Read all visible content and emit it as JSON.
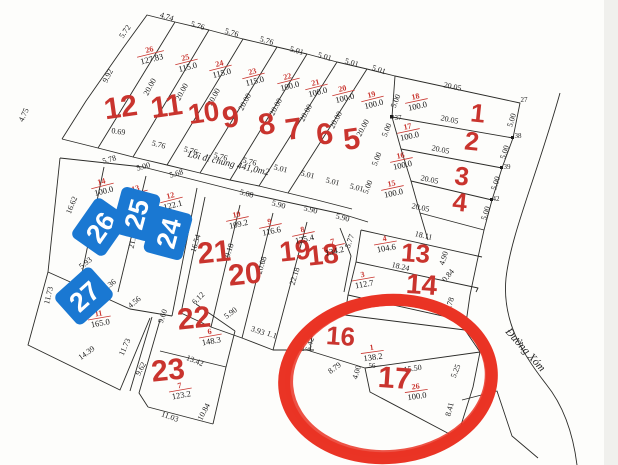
{
  "map": {
    "colors": {
      "background": "#fdfdfb",
      "line": "#2b2b28",
      "plot_number_red": "#c9342e",
      "stamp_blue": "#1a78d2",
      "stamp_text": "#ffffff",
      "highlight_circle": "#ea3425"
    },
    "road_labels": [
      {
        "text": "Lối đi chung 441,0m2",
        "x": 228,
        "y": 166,
        "r": 13,
        "size": 9.5
      },
      {
        "text": "Đường Xóm",
        "x": 523,
        "y": 352,
        "r": 48,
        "size": 11
      }
    ],
    "plot_numbers": [
      {
        "t": "1",
        "x": 477,
        "y": 122,
        "r": 6,
        "s": 26
      },
      {
        "t": "2",
        "x": 471,
        "y": 150,
        "r": 6,
        "s": 26
      },
      {
        "t": "3",
        "x": 461,
        "y": 185,
        "r": 6,
        "s": 26
      },
      {
        "t": "4",
        "x": 459,
        "y": 211,
        "r": 6,
        "s": 26
      },
      {
        "t": "5",
        "x": 353,
        "y": 149,
        "r": -8,
        "s": 30
      },
      {
        "t": "6",
        "x": 326,
        "y": 144,
        "r": -8,
        "s": 30
      },
      {
        "t": "7",
        "x": 295,
        "y": 139,
        "r": -8,
        "s": 30
      },
      {
        "t": "8",
        "x": 268,
        "y": 134,
        "r": -8,
        "s": 30
      },
      {
        "t": "9",
        "x": 232,
        "y": 127,
        "r": -8,
        "s": 30
      },
      {
        "t": "10",
        "x": 205,
        "y": 122,
        "r": -8,
        "s": 28
      },
      {
        "t": "11",
        "x": 168,
        "y": 116,
        "r": -8,
        "s": 30
      },
      {
        "t": "12",
        "x": 122,
        "y": 117,
        "r": -8,
        "s": 30
      },
      {
        "t": "13",
        "x": 415,
        "y": 262,
        "r": 4,
        "s": 26
      },
      {
        "t": "14",
        "x": 421,
        "y": 294,
        "r": 4,
        "s": 28
      },
      {
        "t": "16",
        "x": 340,
        "y": 345,
        "r": 4,
        "s": 26
      },
      {
        "t": "17",
        "x": 394,
        "y": 388,
        "r": 4,
        "s": 30
      },
      {
        "t": "18",
        "x": 324,
        "y": 264,
        "r": -6,
        "s": 28
      },
      {
        "t": "19",
        "x": 296,
        "y": 260,
        "r": -6,
        "s": 28
      },
      {
        "t": "20",
        "x": 246,
        "y": 284,
        "r": -6,
        "s": 30
      },
      {
        "t": "21",
        "x": 215,
        "y": 262,
        "r": -6,
        "s": 30
      },
      {
        "t": "22",
        "x": 195,
        "y": 328,
        "r": -6,
        "s": 30
      },
      {
        "t": "23",
        "x": 169,
        "y": 380,
        "r": -6,
        "s": 30
      }
    ],
    "parcel_labels": [
      {
        "id": "26",
        "area": "127.83",
        "x": 150,
        "y": 52,
        "r": -14
      },
      {
        "id": "25",
        "area": "115.0",
        "x": 186,
        "y": 60,
        "r": -14
      },
      {
        "id": "24",
        "area": "115.0",
        "x": 220,
        "y": 66,
        "r": -14
      },
      {
        "id": "23",
        "area": "115.0",
        "x": 253,
        "y": 74,
        "r": -14
      },
      {
        "id": "22",
        "area": "100.0",
        "x": 288,
        "y": 79,
        "r": -14
      },
      {
        "id": "21",
        "area": "100.0",
        "x": 316,
        "y": 85,
        "r": -14
      },
      {
        "id": "20",
        "area": "100.0",
        "x": 343,
        "y": 91,
        "r": -14
      },
      {
        "id": "19",
        "area": "100.0",
        "x": 372,
        "y": 97,
        "r": -14
      },
      {
        "id": "18",
        "area": "100.0",
        "x": 416,
        "y": 99,
        "r": -12
      },
      {
        "id": "17",
        "area": "100.0",
        "x": 408,
        "y": 129,
        "r": -12
      },
      {
        "id": "16",
        "area": "100.0",
        "x": 401,
        "y": 158,
        "r": -12
      },
      {
        "id": "15",
        "area": "100.0",
        "x": 392,
        "y": 186,
        "r": -12
      },
      {
        "id": "14",
        "area": "100.0",
        "x": 102,
        "y": 184,
        "r": -14
      },
      {
        "id": "13",
        "area": "100.0",
        "x": 136,
        "y": 191,
        "r": -14
      },
      {
        "id": "12",
        "area": "122.1",
        "x": 171,
        "y": 198,
        "r": -14
      },
      {
        "id": "10",
        "area": "109.2",
        "x": 237,
        "y": 217,
        "r": -12
      },
      {
        "id": "9",
        "area": "116.6",
        "x": 270,
        "y": 224,
        "r": -12
      },
      {
        "id": "8",
        "area": "125.4",
        "x": 303,
        "y": 232,
        "r": -12
      },
      {
        "id": "7",
        "area": "134.2",
        "x": 333,
        "y": 244,
        "r": -12
      },
      {
        "id": "4",
        "area": "104.6",
        "x": 385,
        "y": 241,
        "r": -10
      },
      {
        "id": "3",
        "area": "112.7",
        "x": 363,
        "y": 277,
        "r": -10
      },
      {
        "id": "2",
        "area": "",
        "x": 357,
        "y": 306,
        "r": -10
      },
      {
        "id": "11",
        "area": "165.0",
        "x": 99,
        "y": 316,
        "r": -10
      },
      {
        "id": "6",
        "area": "148.3",
        "x": 210,
        "y": 334,
        "r": -10
      },
      {
        "id": "7",
        "area": "123.2",
        "x": 180,
        "y": 388,
        "r": -10
      },
      {
        "id": "1",
        "area": "138.2",
        "x": 372,
        "y": 350,
        "r": -8
      },
      {
        "id": "26",
        "area": "100.0",
        "x": 416,
        "y": 389,
        "r": -8
      }
    ],
    "dimensions": [
      {
        "t": "4.74",
        "x": 166,
        "y": 19,
        "r": 18
      },
      {
        "t": "5.76",
        "x": 197,
        "y": 28,
        "r": 17
      },
      {
        "t": "5.76",
        "x": 231,
        "y": 35,
        "r": 17
      },
      {
        "t": "5.76",
        "x": 266,
        "y": 43,
        "r": 17
      },
      {
        "t": "5.01",
        "x": 296,
        "y": 53,
        "r": 17
      },
      {
        "t": "5.01",
        "x": 324,
        "y": 59,
        "r": 17
      },
      {
        "t": "5.01",
        "x": 351,
        "y": 65,
        "r": 17
      },
      {
        "t": "5.01",
        "x": 378,
        "y": 72,
        "r": 20
      },
      {
        "t": "5.72",
        "x": 127,
        "y": 33,
        "r": -55
      },
      {
        "t": "9.92",
        "x": 110,
        "y": 77,
        "r": -63
      },
      {
        "t": "4.75",
        "x": 26,
        "y": 116,
        "r": -65
      },
      {
        "t": "0.69",
        "x": 118,
        "y": 134,
        "r": 8
      },
      {
        "t": "20.05",
        "x": 452,
        "y": 89,
        "r": 12
      },
      {
        "t": "20.05",
        "x": 449,
        "y": 122,
        "r": 12
      },
      {
        "t": "20.05",
        "x": 440,
        "y": 152,
        "r": 12
      },
      {
        "t": "20.05",
        "x": 429,
        "y": 182,
        "r": 12
      },
      {
        "t": "20.05",
        "x": 420,
        "y": 210,
        "r": 12
      },
      {
        "t": "5.00",
        "x": 514,
        "y": 121,
        "r": -72
      },
      {
        "t": "5.00",
        "x": 507,
        "y": 153,
        "r": -72
      },
      {
        "t": "5.00",
        "x": 498,
        "y": 184,
        "r": -72
      },
      {
        "t": "5.00",
        "x": 488,
        "y": 214,
        "r": -72
      },
      {
        "t": "5.00",
        "x": 398,
        "y": 102,
        "r": -68
      },
      {
        "t": "5.00",
        "x": 389,
        "y": 131,
        "r": -68
      },
      {
        "t": "5.00",
        "x": 379,
        "y": 160,
        "r": -68
      },
      {
        "t": "5.00",
        "x": 370,
        "y": 188,
        "r": -68
      },
      {
        "t": "20.00",
        "x": 152,
        "y": 88,
        "r": -62
      },
      {
        "t": "20.00",
        "x": 184,
        "y": 93,
        "r": -62
      },
      {
        "t": "20.00",
        "x": 216,
        "y": 98,
        "r": -62
      },
      {
        "t": "20.00",
        "x": 247,
        "y": 103,
        "r": -62
      },
      {
        "t": "20.00",
        "x": 278,
        "y": 108,
        "r": -62
      },
      {
        "t": "20.00",
        "x": 308,
        "y": 114,
        "r": -62
      },
      {
        "t": "20.00",
        "x": 338,
        "y": 121,
        "r": -62
      },
      {
        "t": "20.00",
        "x": 365,
        "y": 129,
        "r": -62
      },
      {
        "t": "5.76",
        "x": 158,
        "y": 147,
        "r": 15
      },
      {
        "t": "5.76",
        "x": 190,
        "y": 153,
        "r": 15
      },
      {
        "t": "5.76",
        "x": 220,
        "y": 159,
        "r": 15
      },
      {
        "t": "5.76",
        "x": 249,
        "y": 164,
        "r": 15
      },
      {
        "t": "5.01",
        "x": 280,
        "y": 171,
        "r": 15
      },
      {
        "t": "5.01",
        "x": 307,
        "y": 177,
        "r": 15
      },
      {
        "t": "5.01",
        "x": 332,
        "y": 184,
        "r": 15
      },
      {
        "t": "5.01",
        "x": 356,
        "y": 190,
        "r": 15
      },
      {
        "t": "5.78",
        "x": 110,
        "y": 162,
        "r": -16
      },
      {
        "t": "5.00",
        "x": 144,
        "y": 169,
        "r": -16
      },
      {
        "t": "5.68",
        "x": 177,
        "y": 176,
        "r": -16
      },
      {
        "t": "5.08",
        "x": 246,
        "y": 196,
        "r": 14
      },
      {
        "t": "5.90",
        "x": 278,
        "y": 207,
        "r": 14
      },
      {
        "t": "5.90",
        "x": 310,
        "y": 212,
        "r": 14
      },
      {
        "t": "5.90",
        "x": 342,
        "y": 220,
        "r": 14
      },
      {
        "t": "5.77",
        "x": 352,
        "y": 242,
        "r": -70
      },
      {
        "t": "16.62",
        "x": 74,
        "y": 206,
        "r": -68
      },
      {
        "t": "21.2",
        "x": 135,
        "y": 242,
        "r": -78
      },
      {
        "t": "21.73",
        "x": 172,
        "y": 249,
        "r": -78
      },
      {
        "t": "16.54",
        "x": 198,
        "y": 244,
        "r": -73
      },
      {
        "t": "19.18",
        "x": 231,
        "y": 253,
        "r": -73
      },
      {
        "t": "20.68",
        "x": 264,
        "y": 266,
        "r": -73
      },
      {
        "t": "22.18",
        "x": 297,
        "y": 277,
        "r": -73
      },
      {
        "t": "5.93",
        "x": 87,
        "y": 265,
        "r": -38
      },
      {
        "t": "5.36",
        "x": 111,
        "y": 287,
        "r": -38
      },
      {
        "t": "4.56",
        "x": 136,
        "y": 304,
        "r": -40
      },
      {
        "t": "11.73",
        "x": 51,
        "y": 296,
        "r": -76
      },
      {
        "t": "14.39",
        "x": 88,
        "y": 355,
        "r": -36
      },
      {
        "t": "11.73",
        "x": 127,
        "y": 348,
        "r": -66
      },
      {
        "t": "9.60",
        "x": 165,
        "y": 317,
        "r": -70
      },
      {
        "t": "9.62",
        "x": 143,
        "y": 370,
        "r": -62
      },
      {
        "t": "6.12",
        "x": 200,
        "y": 300,
        "r": -44
      },
      {
        "t": "13.42",
        "x": 194,
        "y": 363,
        "r": 22
      },
      {
        "t": "11.03",
        "x": 169,
        "y": 419,
        "r": 20
      },
      {
        "t": "10.84",
        "x": 206,
        "y": 413,
        "r": -62
      },
      {
        "t": "5.90",
        "x": 232,
        "y": 315,
        "r": -36
      },
      {
        "t": "3.93",
        "x": 257,
        "y": 333,
        "r": 20
      },
      {
        "t": "1.1",
        "x": 271,
        "y": 337,
        "r": 20
      },
      {
        "t": "18.11",
        "x": 423,
        "y": 238,
        "r": 13
      },
      {
        "t": "4.90",
        "x": 446,
        "y": 259,
        "r": -72
      },
      {
        "t": "0.84",
        "x": 450,
        "y": 277,
        "r": -50
      },
      {
        "t": "18.24",
        "x": 400,
        "y": 269,
        "r": 13
      },
      {
        "t": "20.71",
        "x": 399,
        "y": 302,
        "r": 13
      },
      {
        "t": "5.78",
        "x": 452,
        "y": 305,
        "r": -72
      },
      {
        "t": "6.42",
        "x": 312,
        "y": 345,
        "r": -74
      },
      {
        "t": "8.79",
        "x": 336,
        "y": 370,
        "r": -36
      },
      {
        "t": "4.00",
        "x": 359,
        "y": 373,
        "r": -74
      },
      {
        "t": "15.50",
        "x": 413,
        "y": 371,
        "r": -8
      },
      {
        "t": "5.25",
        "x": 458,
        "y": 372,
        "r": -68
      },
      {
        "t": "8.41",
        "x": 452,
        "y": 410,
        "r": -76
      }
    ],
    "point_labels": [
      {
        "t": "27",
        "x": 524,
        "y": 102
      },
      {
        "t": "38",
        "x": 518,
        "y": 138
      },
      {
        "t": "39",
        "x": 507,
        "y": 169
      },
      {
        "t": "42",
        "x": 496,
        "y": 201
      },
      {
        "t": "37",
        "x": 398,
        "y": 120
      },
      {
        "t": "53",
        "x": 319,
        "y": 322
      },
      {
        "t": "58",
        "x": 301,
        "y": 351
      },
      {
        "t": "56",
        "x": 372,
        "y": 368
      }
    ],
    "stamps": [
      {
        "t": "26",
        "x": 100,
        "y": 227,
        "r": -55
      },
      {
        "t": "25",
        "x": 136,
        "y": 214,
        "r": -75
      },
      {
        "t": "24",
        "x": 168,
        "y": 233,
        "r": -75
      },
      {
        "t": "27",
        "x": 84,
        "y": 296,
        "r": -42
      }
    ],
    "highlight": {
      "cx": 388,
      "cy": 379,
      "rx": 104,
      "ry": 79,
      "r": -5
    }
  }
}
